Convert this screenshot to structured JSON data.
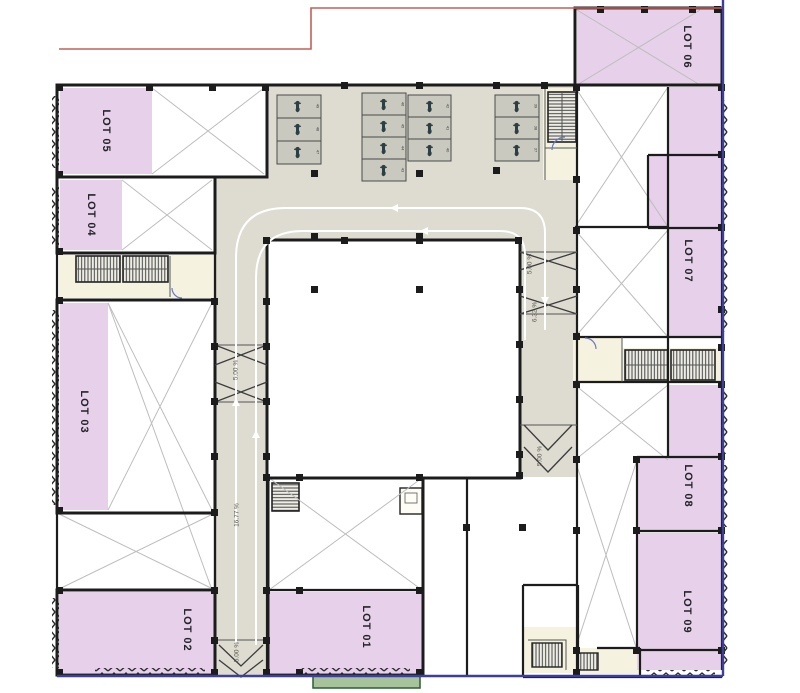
{
  "title": "Parking level floor plan",
  "colors": {
    "lot_fill": "#e6d0ea",
    "drive_fill": "#dedcd0",
    "cream_fill": "#f5f2df",
    "stall_fill": "#cac9bf",
    "green_fill": "#a6c39c",
    "green_border": "#2e5c33",
    "wall": "#1c1c1c",
    "xline": "#bdbdbd",
    "boundary_red": "#c65f57",
    "boundary_blue": "#3c3f9f",
    "label": "#23232b",
    "ramp_label": "#56564e"
  },
  "lots": [
    {
      "id": "lot-01",
      "label": "LOT 01"
    },
    {
      "id": "lot-02",
      "label": "LOT 02"
    },
    {
      "id": "lot-03",
      "label": "LOT 03"
    },
    {
      "id": "lot-04",
      "label": "LOT 04"
    },
    {
      "id": "lot-05",
      "label": "LOT 05"
    },
    {
      "id": "lot-06",
      "label": "LOT 06"
    },
    {
      "id": "lot-07",
      "label": "LOT 07"
    },
    {
      "id": "lot-08",
      "label": "LOT 08"
    },
    {
      "id": "lot-09",
      "label": "LOT 09"
    }
  ],
  "ramps": {
    "left_top": "5.00 %",
    "left_mid": "16.77 %",
    "left_bottom": "5.00 %",
    "right_top": "5.00 %",
    "right_mid": "6.32 %",
    "right_bottom": "5.00 %"
  },
  "parking": {
    "stalls": [
      "49",
      "48",
      "47",
      "46",
      "45",
      "44",
      "43",
      "42",
      "41",
      "40",
      "39",
      "38",
      "37"
    ]
  }
}
